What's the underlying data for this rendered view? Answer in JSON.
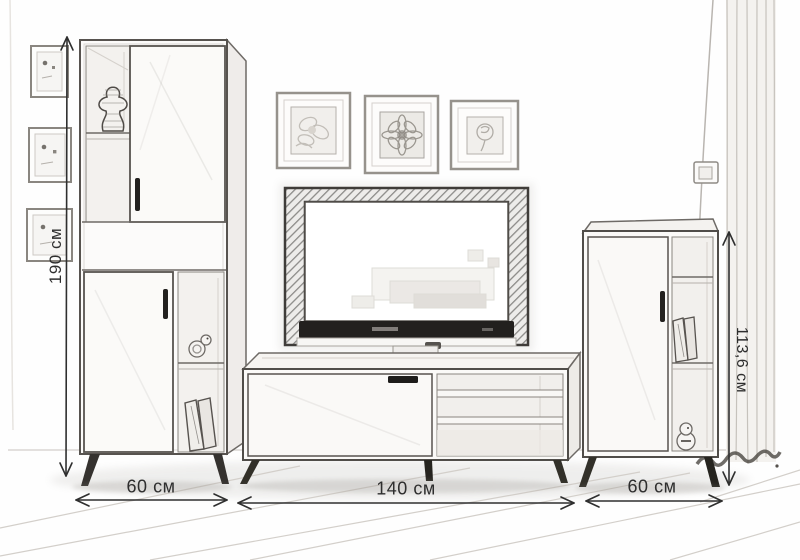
{
  "dimension_labels": {
    "left_height": "190 см",
    "right_height": "113,6 см",
    "bottom_left_width": "60 см",
    "bottom_center_width": "140 см",
    "bottom_right_width": "60 см"
  },
  "colors": {
    "paper": "#fefefe",
    "pencil_ink": "#4a4742",
    "dark_accent": "#22201e",
    "dimension_ink": "#2e2e2e",
    "soft_shade": "#efedea"
  }
}
